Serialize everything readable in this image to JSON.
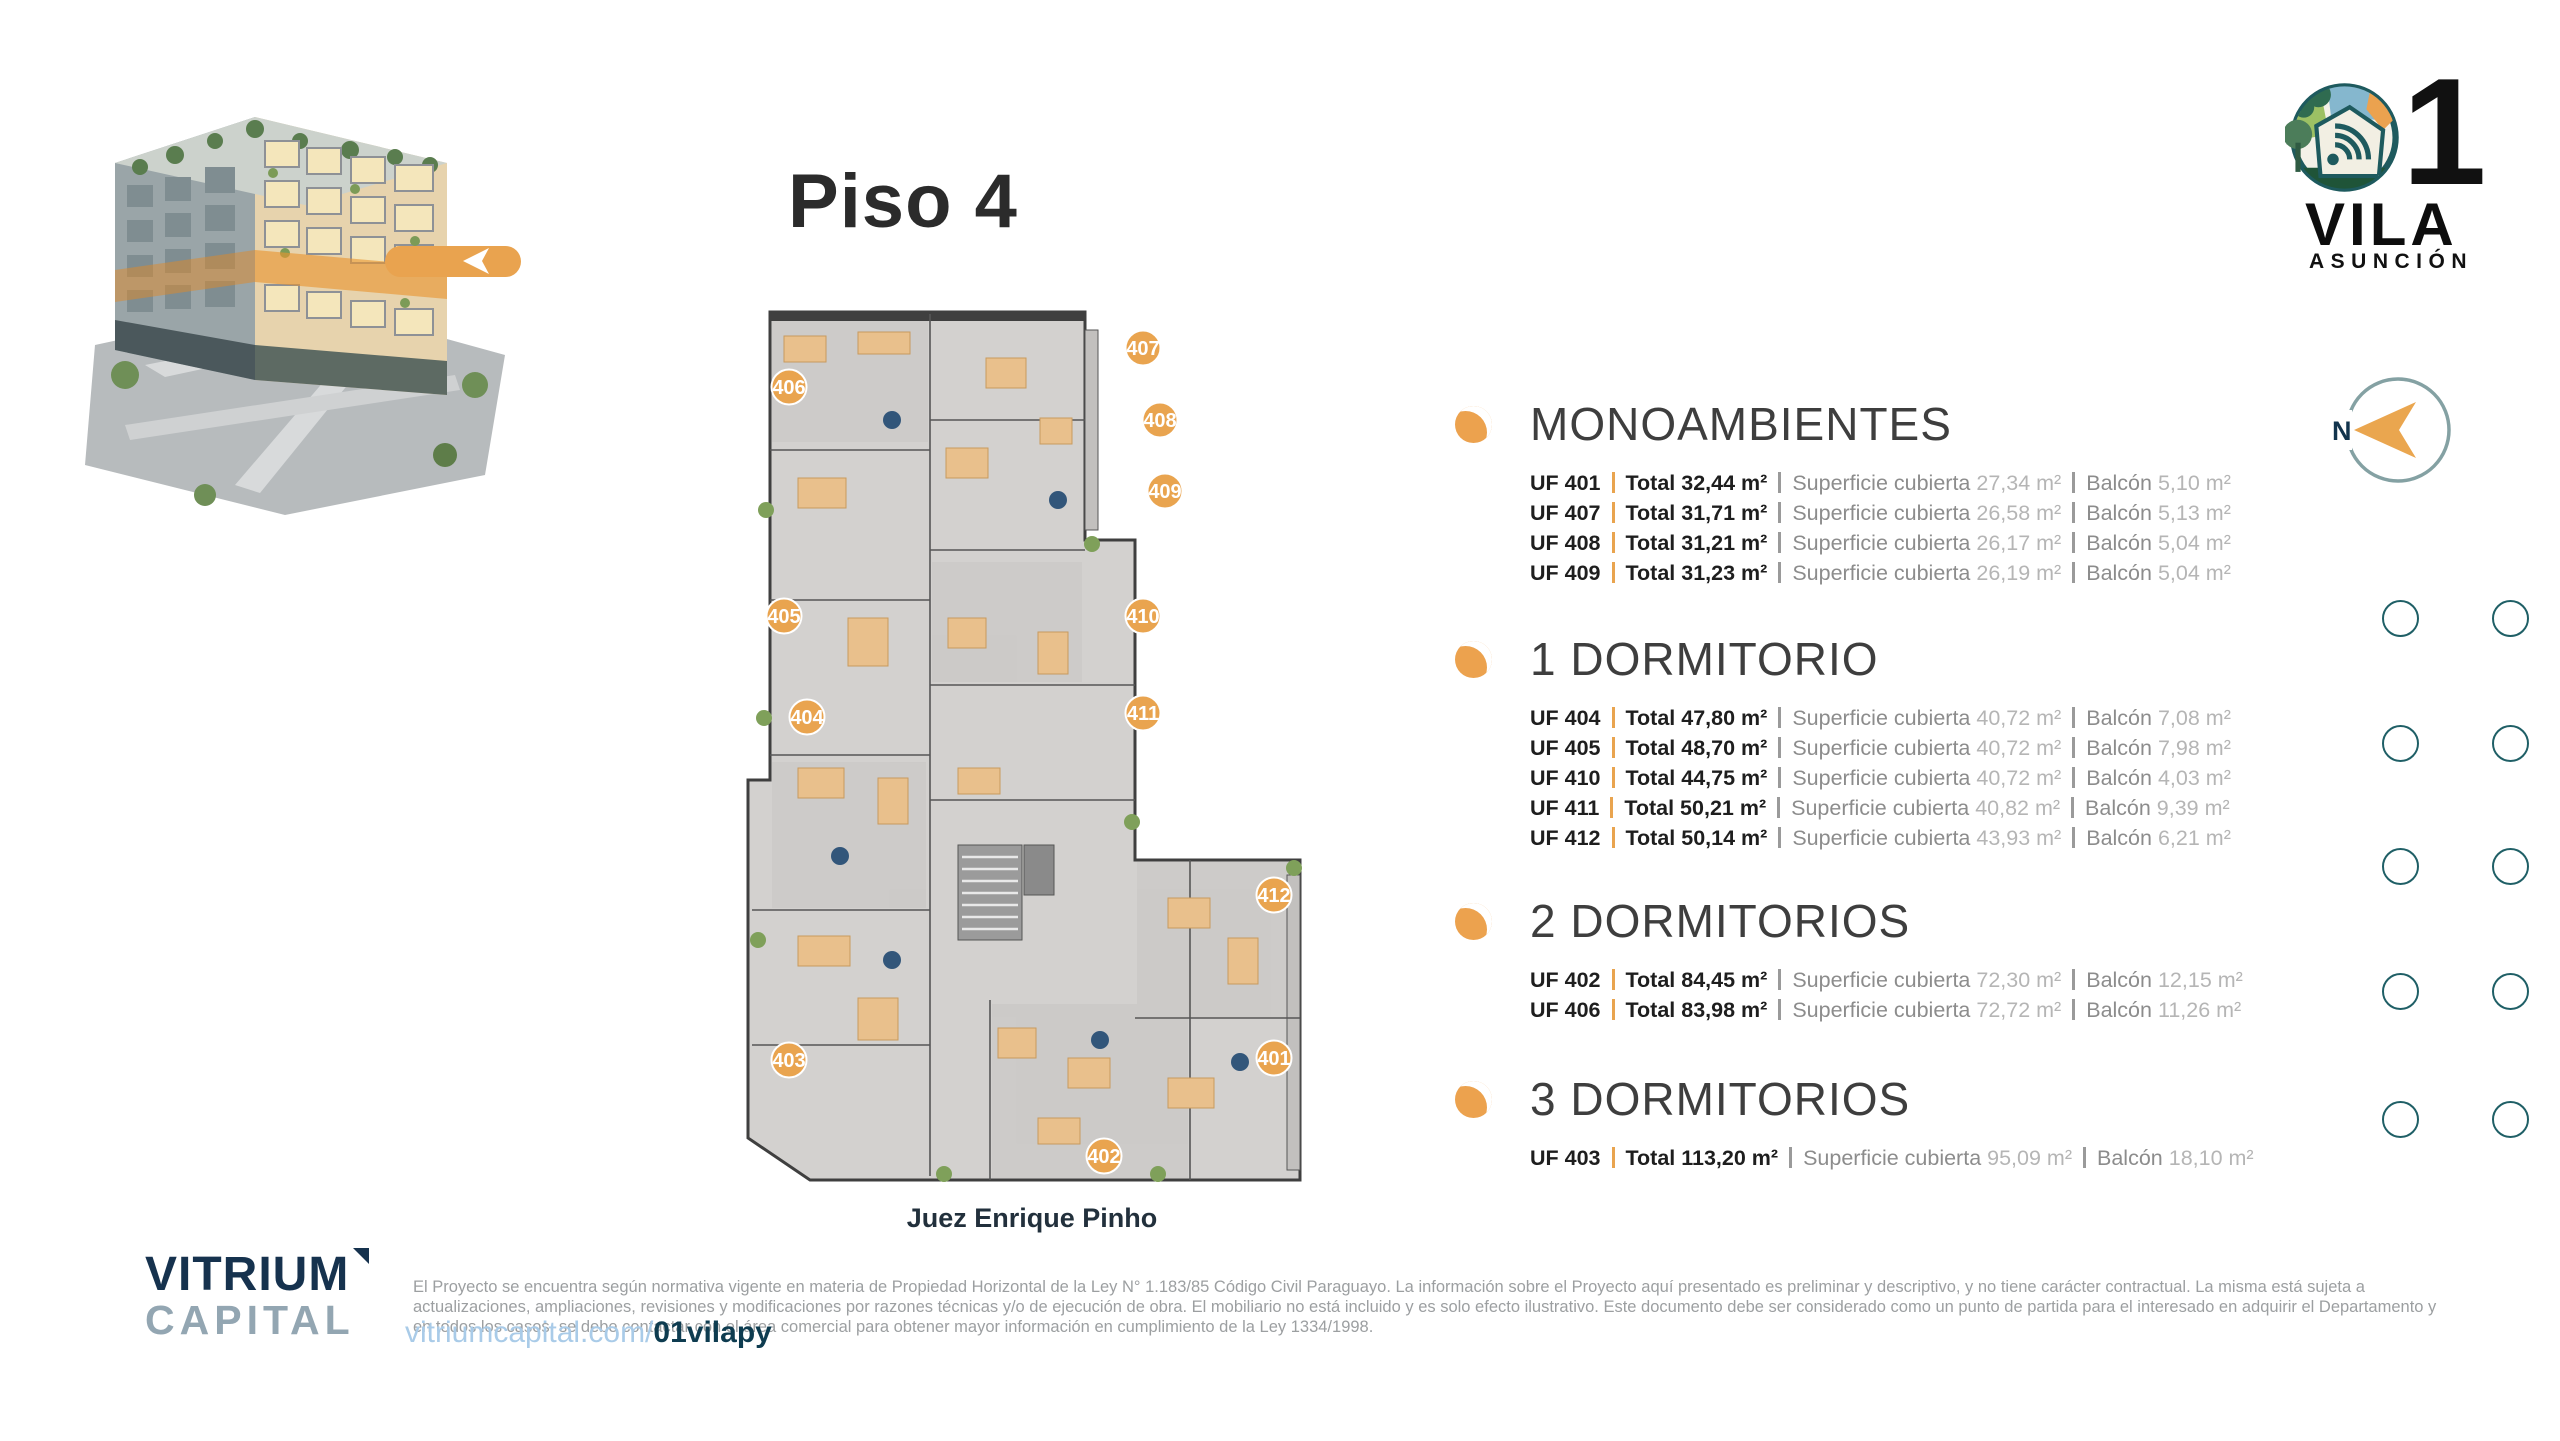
{
  "page": {
    "title": "Piso 4"
  },
  "brand": {
    "number": "1",
    "name": "VILA",
    "city": "ASUNCIÓN",
    "developer_line1": "VITRIUM",
    "developer_line2": "CAPITAL",
    "website_base": "vitriumcapital.com/",
    "website_slug": "01vilapy"
  },
  "compass": {
    "label": "N"
  },
  "floorplan": {
    "street_label": "Juez Enrique Pinho",
    "badges": [
      {
        "label": "406",
        "x": 49,
        "y": 87
      },
      {
        "label": "407",
        "x": 403,
        "y": 48
      },
      {
        "label": "408",
        "x": 420,
        "y": 120
      },
      {
        "label": "409",
        "x": 425,
        "y": 191
      },
      {
        "label": "405",
        "x": 44,
        "y": 316
      },
      {
        "label": "410",
        "x": 403,
        "y": 316
      },
      {
        "label": "404",
        "x": 67,
        "y": 417
      },
      {
        "label": "411",
        "x": 403,
        "y": 413
      },
      {
        "label": "412",
        "x": 534,
        "y": 595
      },
      {
        "label": "403",
        "x": 49,
        "y": 760
      },
      {
        "label": "401",
        "x": 534,
        "y": 758
      },
      {
        "label": "402",
        "x": 364,
        "y": 856
      }
    ]
  },
  "sections": [
    {
      "title": "MONOAMBIENTES",
      "units": [
        {
          "uf": "UF 401",
          "total": "Total 32,44 m²",
          "sup_label": "Superficie cubierta",
          "sup": "27,34 m²",
          "bal_label": "Balcón",
          "bal": "5,10 m²"
        },
        {
          "uf": "UF 407",
          "total": "Total 31,71 m²",
          "sup_label": "Superficie cubierta",
          "sup": "26,58 m²",
          "bal_label": "Balcón",
          "bal": "5,13 m²"
        },
        {
          "uf": "UF 408",
          "total": "Total 31,21 m²",
          "sup_label": "Superficie cubierta",
          "sup": "26,17 m²",
          "bal_label": "Balcón",
          "bal": "5,04 m²"
        },
        {
          "uf": "UF 409",
          "total": "Total 31,23 m²",
          "sup_label": "Superficie cubierta",
          "sup": "26,19 m²",
          "bal_label": "Balcón",
          "bal": "5,04 m²"
        }
      ]
    },
    {
      "title": "1 DORMITORIO",
      "units": [
        {
          "uf": "UF 404",
          "total": "Total 47,80 m²",
          "sup_label": "Superficie cubierta",
          "sup": "40,72 m²",
          "bal_label": "Balcón",
          "bal": "7,08 m²"
        },
        {
          "uf": "UF 405",
          "total": "Total 48,70 m²",
          "sup_label": "Superficie cubierta",
          "sup": "40,72 m²",
          "bal_label": "Balcón",
          "bal": "7,98 m²"
        },
        {
          "uf": "UF 410",
          "total": "Total 44,75 m²",
          "sup_label": "Superficie cubierta",
          "sup": "40,72 m²",
          "bal_label": "Balcón",
          "bal": "4,03 m²"
        },
        {
          "uf": "UF 411",
          "total": "Total 50,21 m²",
          "sup_label": "Superficie cubierta",
          "sup": "40,82 m²",
          "bal_label": "Balcón",
          "bal": "9,39 m²"
        },
        {
          "uf": "UF 412",
          "total": "Total 50,14 m²",
          "sup_label": "Superficie cubierta",
          "sup": "43,93 m²",
          "bal_label": "Balcón",
          "bal": "6,21 m²"
        }
      ]
    },
    {
      "title": "2 DORMITORIOS",
      "units": [
        {
          "uf": "UF 402",
          "total": "Total 84,45 m²",
          "sup_label": "Superficie cubierta",
          "sup": "72,30 m²",
          "bal_label": "Balcón",
          "bal": "12,15 m²"
        },
        {
          "uf": "UF 406",
          "total": "Total 83,98 m²",
          "sup_label": "Superficie cubierta",
          "sup": "72,72 m²",
          "bal_label": "Balcón",
          "bal": "11,26 m²"
        }
      ]
    },
    {
      "title": "3 DORMITORIOS",
      "units": [
        {
          "uf": "UF 403",
          "total": "Total 113,20 m²",
          "sup_label": "Superficie cubierta",
          "sup": "95,09 m²",
          "bal_label": "Balcón",
          "bal": "18,10 m²"
        }
      ]
    }
  ],
  "footer": {
    "disclaimer": "El Proyecto se encuentra según normativa vigente en materia de Propiedad Horizontal de la Ley N° 1.183/85 Código Civil Paraguayo. La información sobre el Proyecto aquí presentado es preliminar y descriptivo, y no tiene carácter contractual. La misma está sujeta a actualizaciones, ampliaciones, revisiones y modificaciones por razones técnicas y/o de ejecución de obra. El mobiliario no está incluido y es solo efecto ilustrativo. Este documento debe ser considerado como un punto de partida para el interesado en adquirir el Departamento y en todos los casos, se debe contactar con el área comercial para obtener mayor información en cumplimiento de la Ley 1334/1998."
  },
  "colors": {
    "accent_orange": "#E9A44F",
    "teal_ring": "#1F5F66",
    "navy": "#12344D",
    "dark_text": "#1E1E1E",
    "gray_label": "#8C8C8C",
    "gray_value": "#B5B5B5"
  },
  "floor_dots": {
    "rows": 5,
    "cols": 2
  }
}
